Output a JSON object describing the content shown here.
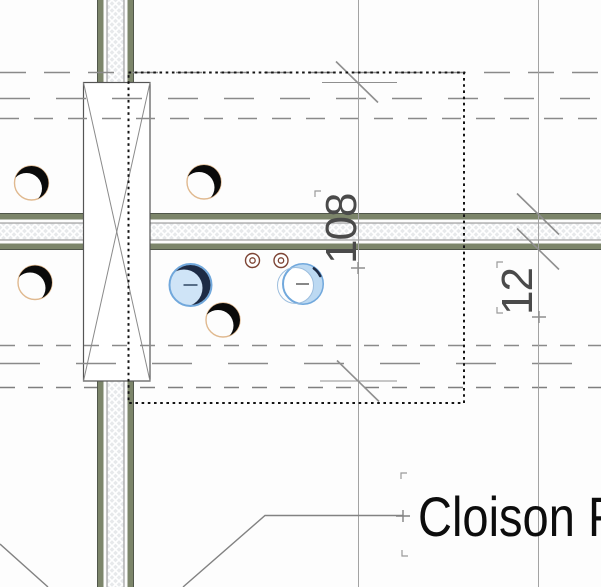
{
  "view": {
    "type": "cad-floor-plan-detail",
    "selection_active": true
  },
  "annotations": {
    "dimensions": [
      {
        "id": "dim-108",
        "value": "108",
        "orientation": "vertical"
      },
      {
        "id": "dim-12",
        "value": "12",
        "orientation": "vertical"
      }
    ],
    "text_note": {
      "label": "Cloison F"
    }
  },
  "symbols": {
    "column_cross_box": 1,
    "hole_markers_black": 4,
    "selected_hole_markers_blue": 2,
    "double_ring_markers": 2
  },
  "colors": {
    "wall_edge_olive": "#7c856a",
    "wall_edge_dark": "#50564a",
    "wall_core_fill": "#e7e9eb",
    "hatch_line": "#ffffff",
    "hole_outline_tan": "#e0b98f",
    "hole_shadow_black": "#0a0a0a",
    "selection_stroke_blue": "#71a8dc",
    "selection_fill_blue": "#cfe4f7",
    "selection_shadow_navy": "#1d2b45",
    "ring_brown": "#7d4434",
    "reference_dash_gray": "#8a8a8a",
    "dimension_gray": "#8f8f8f",
    "dimension_text_gray": "#4a4a4a",
    "marquee_black": "#141414",
    "note_text_black": "#0d0d0d"
  }
}
